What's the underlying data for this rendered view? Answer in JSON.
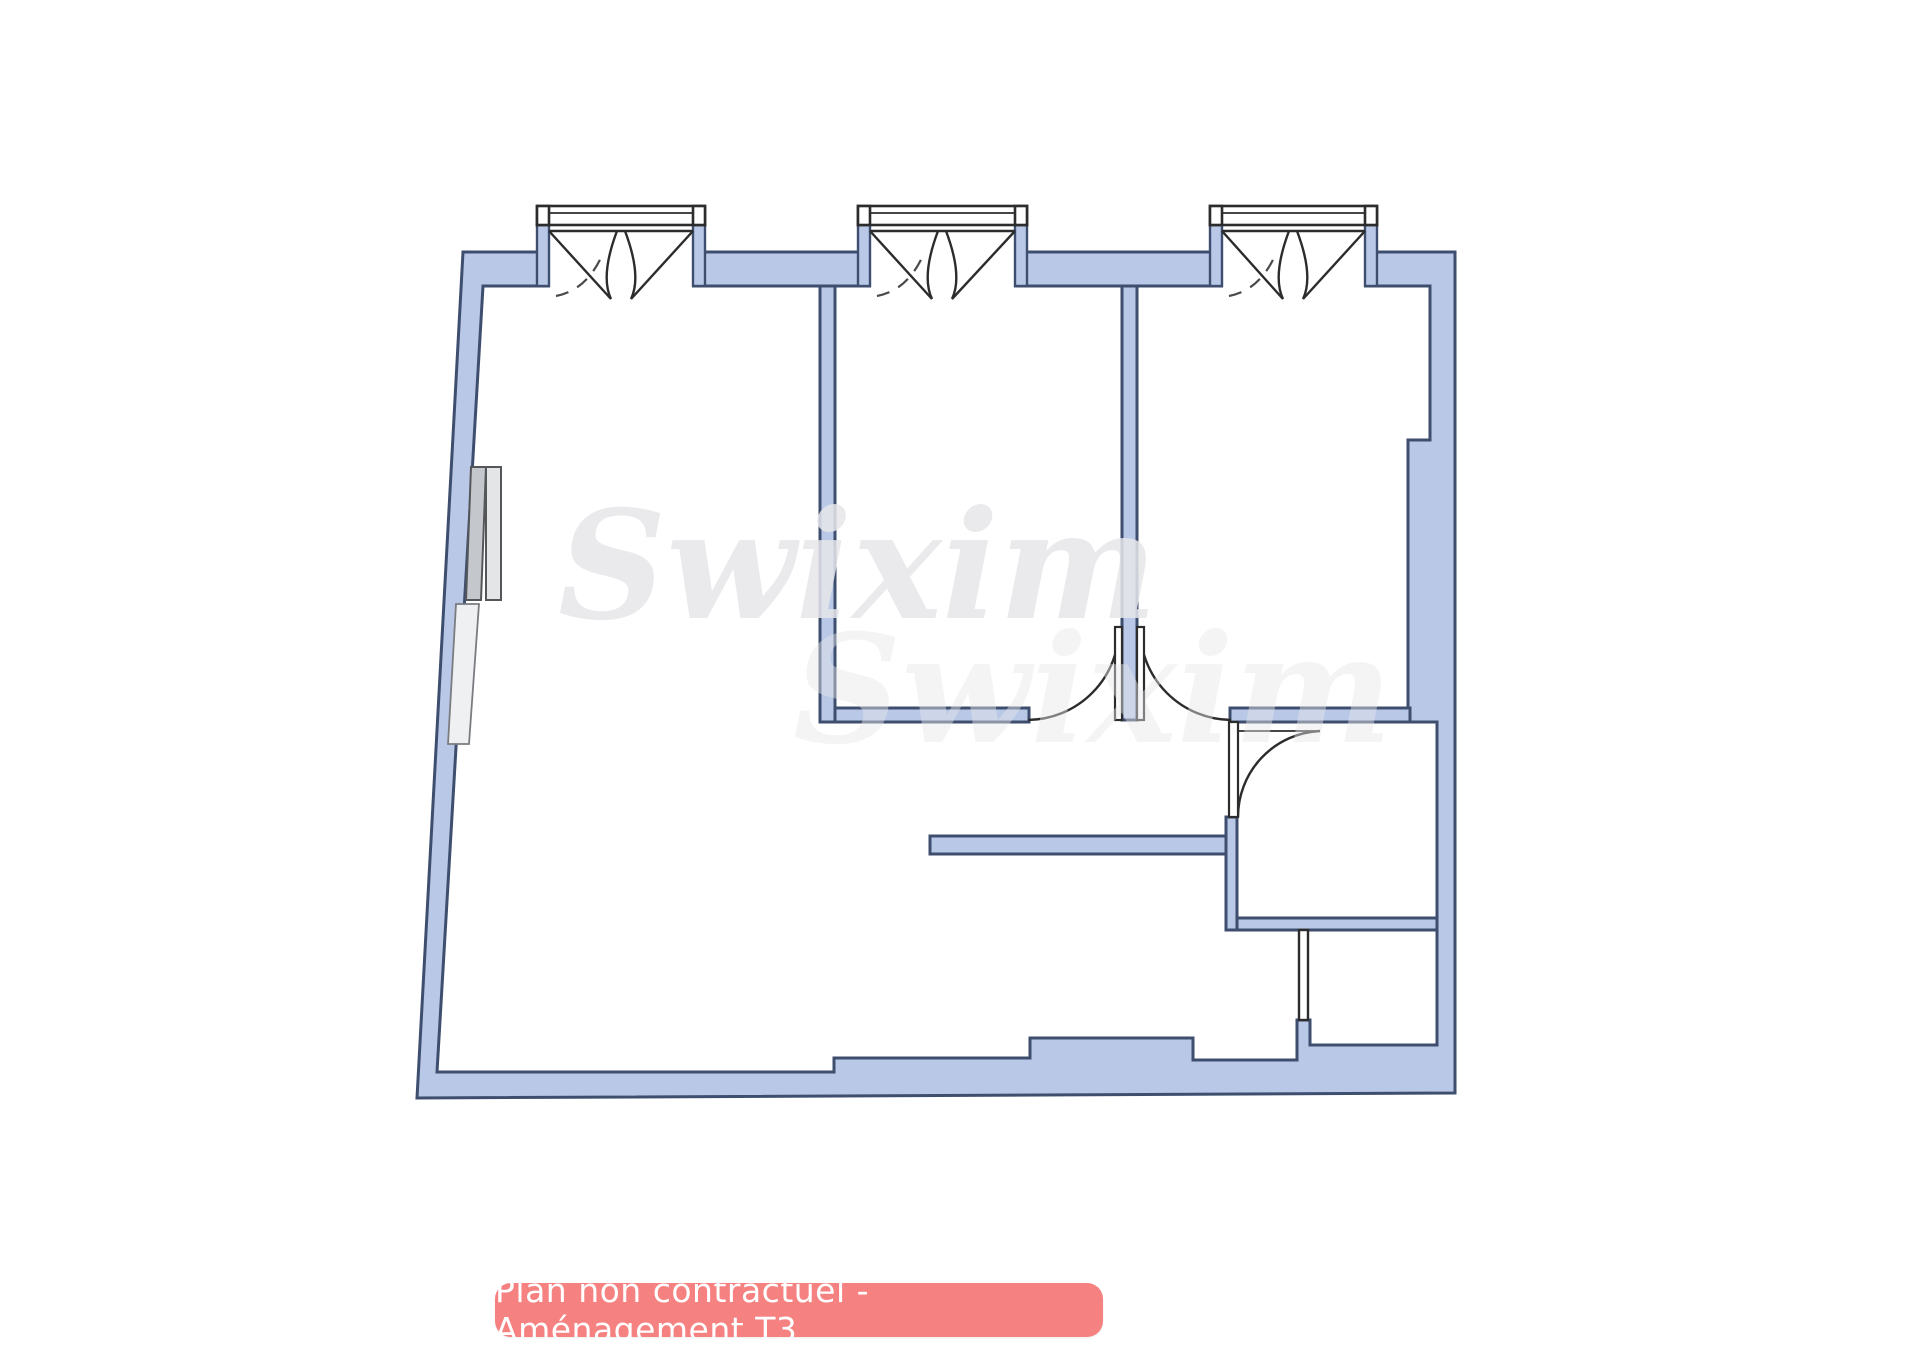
{
  "caption": {
    "label": "Plan non contractuel - Aménagement T3"
  },
  "watermark": {
    "text": "Swixim"
  },
  "plan": {
    "type": "floorplan",
    "description": "T3 apartment floor plan: large living room at left with slanted outer wall, two bedrooms at top right, hallway, bathroom and storage room at bottom right",
    "windows": [
      {
        "name": "window-living-room",
        "style": "double-casement"
      },
      {
        "name": "window-bedroom-1",
        "style": "double-casement"
      },
      {
        "name": "window-bedroom-2",
        "style": "double-casement"
      }
    ],
    "doors": [
      {
        "name": "door-bedroom-1",
        "swing": "quarter-arc"
      },
      {
        "name": "door-bedroom-2",
        "swing": "quarter-arc"
      },
      {
        "name": "door-bathroom",
        "swing": "quarter-arc"
      }
    ],
    "furniture": [
      {
        "name": "chimney-block"
      },
      {
        "name": "radiator"
      }
    ],
    "colors": {
      "wall_fill": "#b9c8e6",
      "wall_stroke": "#3e4e6e",
      "line": "#2c2c2c",
      "caption_bg": "#f58181",
      "caption_text": "#ffffff",
      "watermark": "#e7e7eb",
      "furniture_dark": "#c4c8cc",
      "furniture_light": "#e3e5e7",
      "radiator": "#eef0f1"
    }
  }
}
